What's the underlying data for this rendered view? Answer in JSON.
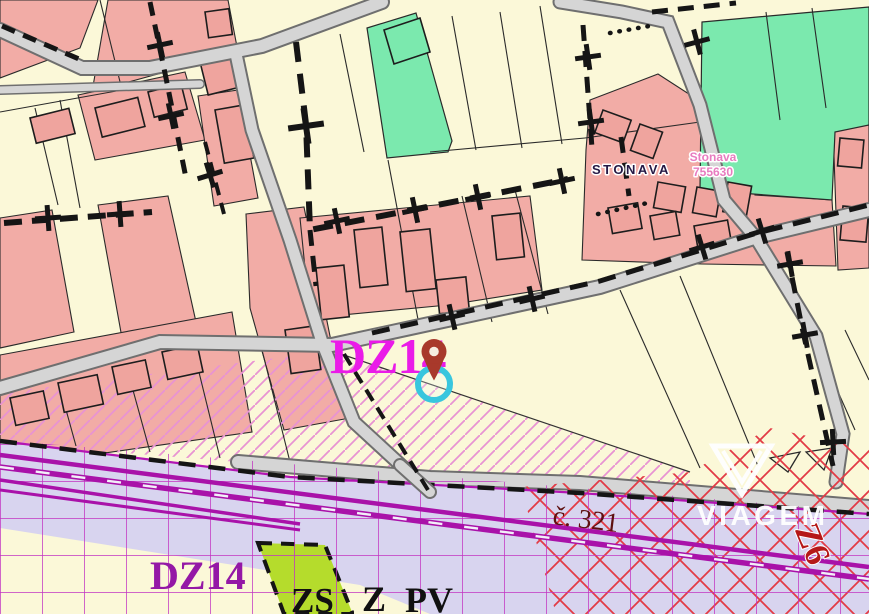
{
  "map": {
    "municipality_label": "STONAVA",
    "cadastral_label": {
      "name": "Stonava",
      "code": "755630"
    },
    "zones": {
      "dz14_primary": "DZ14",
      "dz14_secondary": "DZ14",
      "z6": "Z6",
      "zs": "ZS",
      "z": "Z",
      "pv": "PV"
    },
    "parcel_ref": "č. 321",
    "marker": {
      "type": "location-pin"
    },
    "watermark": {
      "brand": "VIAGEM"
    },
    "colors": {
      "parcel_cream": "#FBF8D8",
      "parcel_pink": "#F2ACA6",
      "parcel_green": "#7BE9AE",
      "parcel_lime": "#B5DC2C",
      "rail_corridor_lavender": "#D8D4EF",
      "road_gray": "#D5D5D5",
      "railway_magenta": "#A912A9",
      "overlay_grid_magenta": "#C234C2",
      "hatch_pink": "#E893D2",
      "crosshatch_red": "#E23B46",
      "dz14_magenta": "#EA1BE8",
      "dz14_purple": "#9418A6",
      "parcel_ref_maroon": "#5E1010",
      "z6_red": "#B51818",
      "pin_brown": "#A8392B",
      "pin_ring_cyan": "#38C6DE"
    }
  }
}
